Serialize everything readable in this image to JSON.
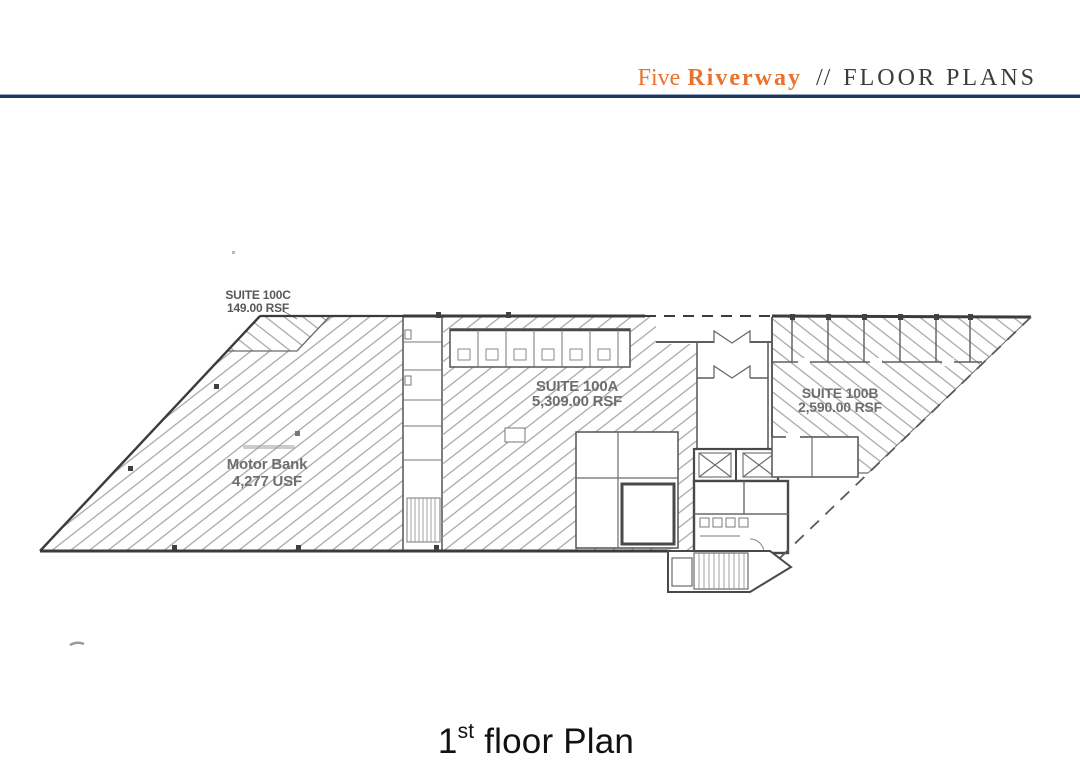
{
  "header": {
    "brand_first": "Five",
    "brand_second": "Riverway",
    "separator": "//",
    "section": "FLOOR PLANS"
  },
  "floor_plan": {
    "suites": [
      {
        "name": "SUITE 100C",
        "area": "149.00 RSF"
      },
      {
        "name": "SUITE 100A",
        "area": "5,309.00 RSF"
      },
      {
        "name": "SUITE 100B",
        "area": "2,590.00 RSF"
      },
      {
        "name": "Motor Bank",
        "area": "4,277 USF"
      }
    ]
  },
  "caption": {
    "number": "1",
    "ordinal": "st",
    "text": " floor Plan"
  },
  "colors": {
    "accent_orange": "#E9732C",
    "header_text": "#3C3C3C",
    "rule_navy": "#1D3A5E",
    "plan_line_gray": "#5E5E5E",
    "hatch_gray": "#9B9B9B",
    "caption_text": "#111111"
  }
}
